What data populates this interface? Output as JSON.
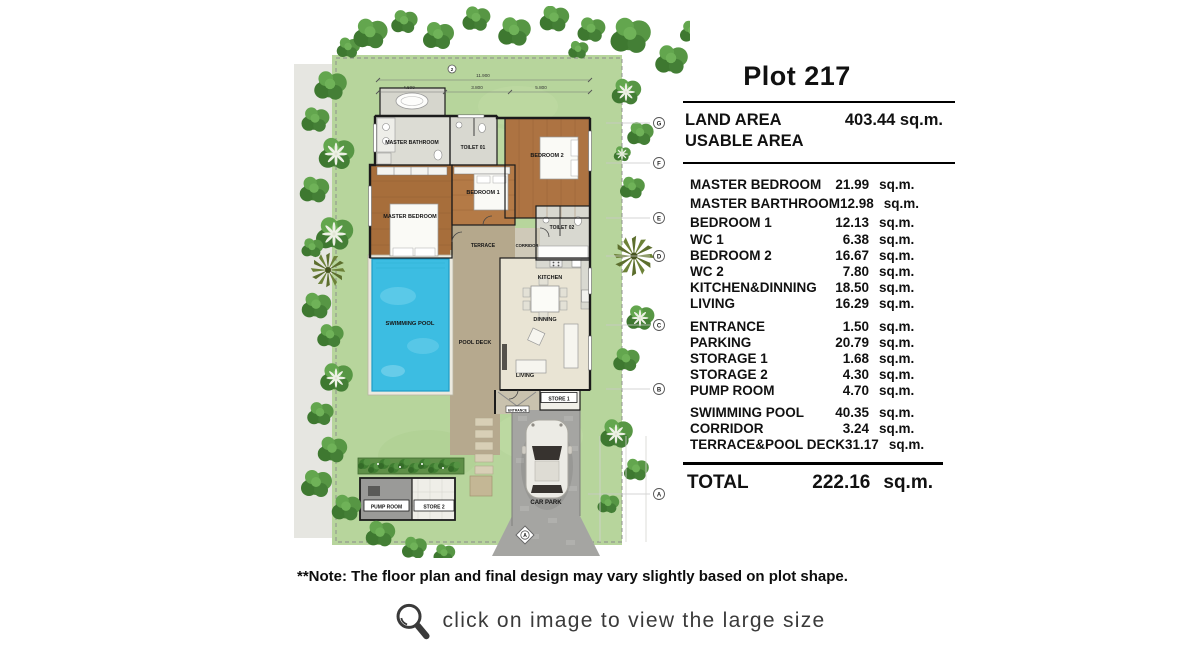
{
  "panel": {
    "title": "Plot 217",
    "land_label": "LAND AREA",
    "land_value": "403.44 sq.m.",
    "usable_label": "USABLE AREA",
    "rows": [
      {
        "name": "MASTER BEDROOM",
        "num": "21.99",
        "unit": "sq.m."
      },
      {
        "name": "MASTER BARTHROOM",
        "num": "12.98",
        "unit": "sq.m."
      },
      {
        "name": "BEDROOM 1",
        "num": "12.13",
        "unit": "sq.m."
      },
      {
        "name": "WC 1",
        "num": "6.38",
        "unit": "sq.m."
      },
      {
        "name": "BEDROOM 2",
        "num": "16.67",
        "unit": "sq.m."
      },
      {
        "name": "WC 2",
        "num": "7.80",
        "unit": "sq.m."
      },
      {
        "name": "KITCHEN&DINNING",
        "num": "18.50",
        "unit": "sq.m."
      },
      {
        "name": "LIVING",
        "num": "16.29",
        "unit": "sq.m."
      },
      {
        "name": "ENTRANCE",
        "num": "1.50",
        "unit": "sq.m."
      },
      {
        "name": "PARKING",
        "num": "20.79",
        "unit": "sq.m."
      },
      {
        "name": "STORAGE 1",
        "num": "1.68",
        "unit": "sq.m."
      },
      {
        "name": "STORAGE 2",
        "num": "4.30",
        "unit": "sq.m."
      },
      {
        "name": "PUMP ROOM",
        "num": "4.70",
        "unit": "sq.m."
      },
      {
        "name": "SWIMMING POOL",
        "num": "40.35",
        "unit": "sq.m."
      },
      {
        "name": "CORRIDOR",
        "num": "3.24",
        "unit": "sq.m."
      },
      {
        "name": "TERRACE&POOL DECK",
        "num": "31.17",
        "unit": "sq.m."
      }
    ],
    "total_label": "TOTAL",
    "total_value": "222.16",
    "total_unit": "sq.m."
  },
  "note": "**Note: The floor plan and final design may vary slightly based on plot shape.",
  "footer": {
    "caption": "click on image to view the large size",
    "icon": "magnifier-icon"
  },
  "plan": {
    "rooms": {
      "master_bathroom": "MASTER BATHROOM",
      "toilet_01": "TOILET 01",
      "bedroom_2": "BEDROOM 2",
      "bedroom_1": "BEDROOM 1",
      "master_bedroom": "MASTER BEDROOM",
      "toilet_02": "TOILET 02",
      "terrace": "TERRACE",
      "corridor": "CORRIDOR",
      "kitchen": "KITCHEN",
      "dinning": "DINNING",
      "living": "LIVING",
      "swimming_pool": "SWIMMING POOL",
      "pool_deck": "POOL DECK",
      "store_1": "STORE 1",
      "entrance": "ENTRANCE",
      "car_park": "CAR PARK",
      "pump_room": "PUMP ROOM",
      "store_2": "STORE 2"
    },
    "dims": {
      "overall": "11.900",
      "seg1": "4.500",
      "seg2": "3.800",
      "seg3": "5.800"
    },
    "grid": {
      "g": "G",
      "f": "F",
      "e": "E",
      "d": "D",
      "c": "C",
      "b": "B",
      "a": "A",
      "a_bottom": "A",
      "col2": "2"
    },
    "colors": {
      "lawn": "#b7d59c",
      "pool": "#3cbde2",
      "wood": "#a9713f",
      "deck": "#b6a98e",
      "driveway": "#a5a5a2",
      "tree": "#4a8639",
      "line": "#000000",
      "caption": "#3a3a3a"
    }
  }
}
